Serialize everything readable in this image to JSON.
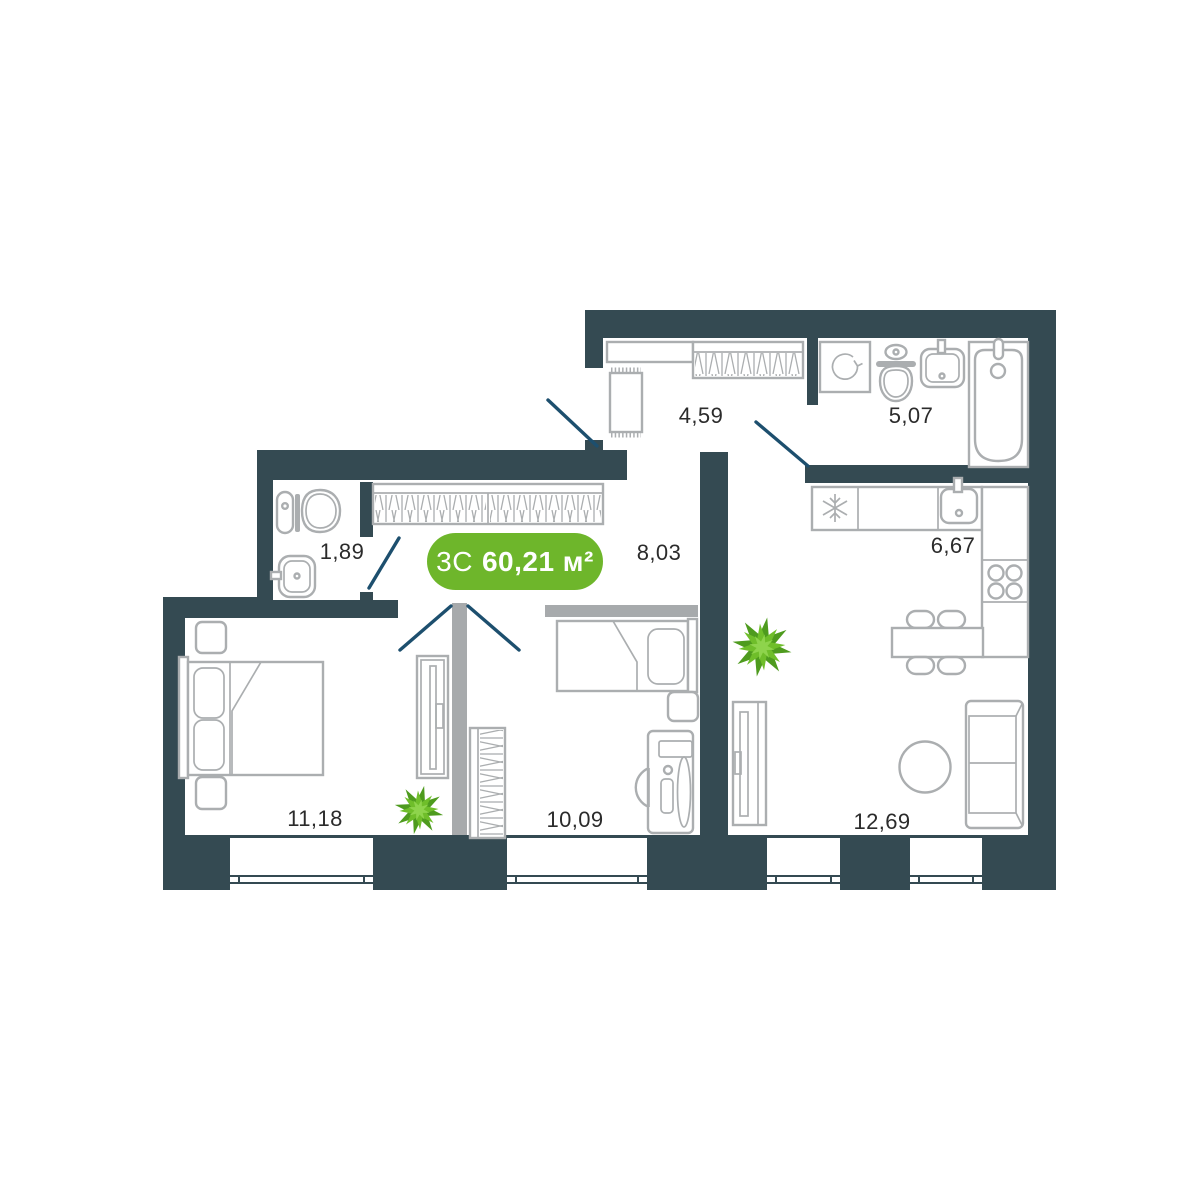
{
  "badge": {
    "type_label": "3С",
    "area_label": "60,21 м²"
  },
  "rooms": [
    {
      "name": "entry-hallway",
      "area": "4,59"
    },
    {
      "name": "bathroom",
      "area": "5,07"
    },
    {
      "name": "wc",
      "area": "1,89"
    },
    {
      "name": "hallway",
      "area": "8,03"
    },
    {
      "name": "kitchen",
      "area": "6,67"
    },
    {
      "name": "bedroom",
      "area": "11,18"
    },
    {
      "name": "room",
      "area": "10,09"
    },
    {
      "name": "living-room",
      "area": "12,69"
    }
  ],
  "icons": {
    "fridge": "snowflake-icon",
    "washing_machine": "rotate-arrow-icon"
  },
  "colors": {
    "wall": "#344a52",
    "partition": "#a7aaac",
    "furniture": "#abaeb0",
    "door": "#1d4f6e",
    "badge_green": "#6eb62b",
    "label": "#2b2b2b",
    "background": "#ffffff",
    "plant_dark": "#4e9b1e",
    "plant_mid": "#6fbe2a",
    "plant_light": "#8ed44c"
  }
}
